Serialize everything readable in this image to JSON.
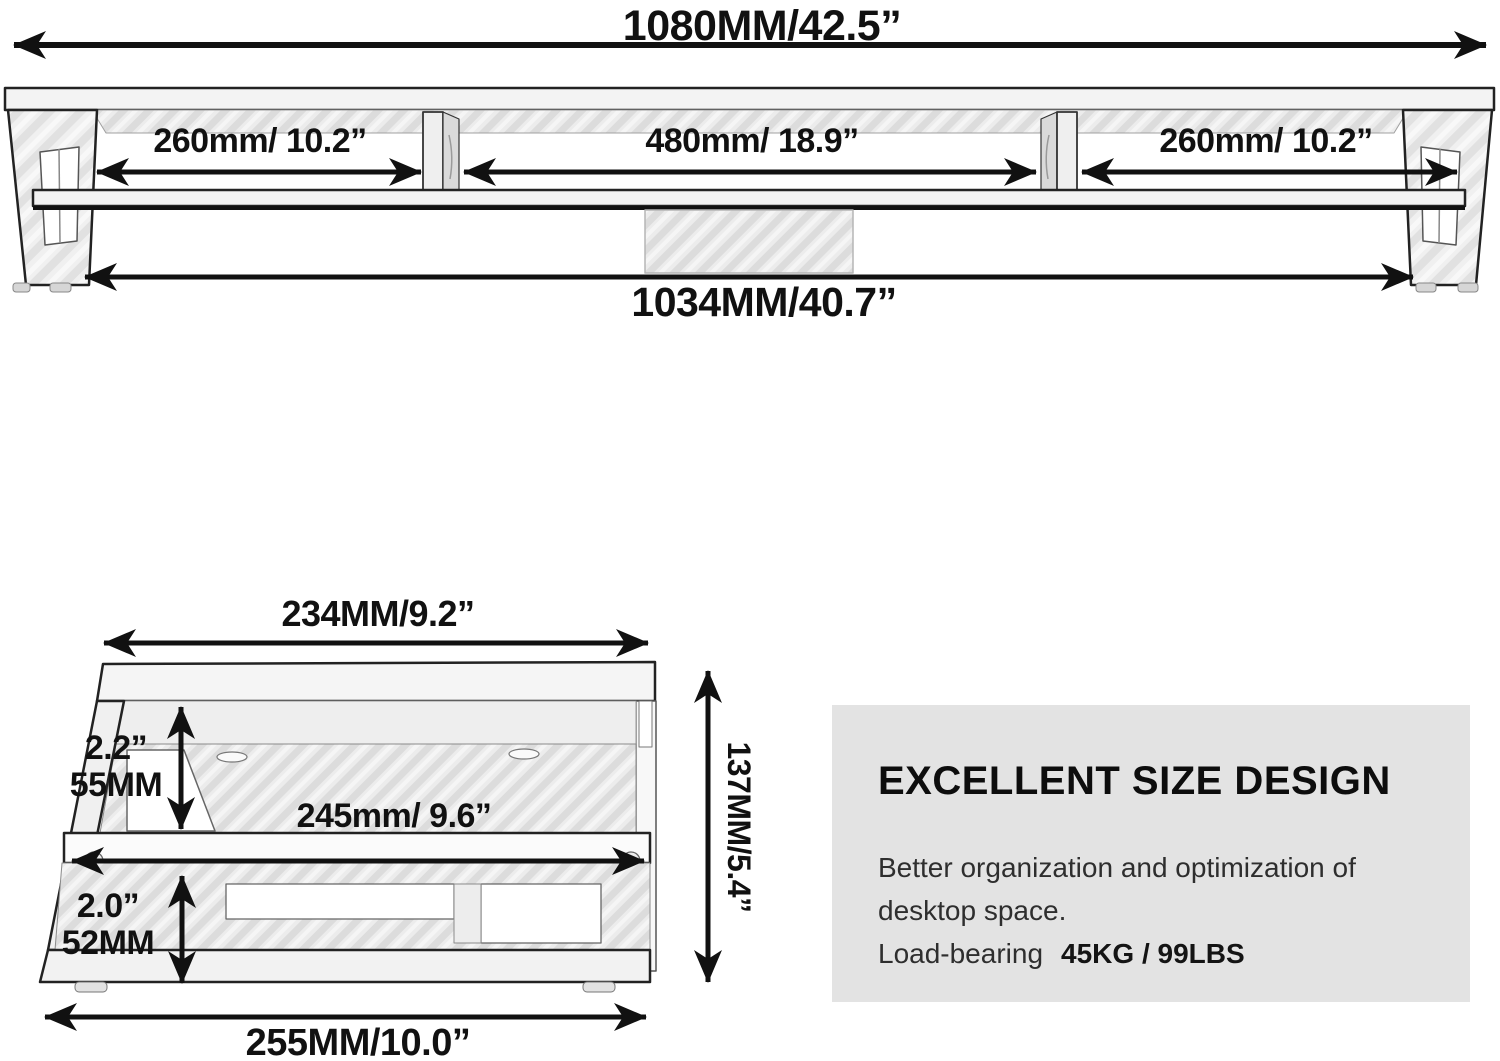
{
  "colors": {
    "line_art": "#111111",
    "drawing_fill_light": "#f2f2f2",
    "hatch_gray": "#dcdcdc",
    "info_box_background": "#e3e3e3"
  },
  "front_view": {
    "overall_width": "1080MM/42.5”",
    "sections": [
      {
        "label": "260mm/ 10.2”"
      },
      {
        "label": "480mm/ 18.9”"
      },
      {
        "label": "260mm/ 10.2”"
      }
    ],
    "inner_width": "1034MM/40.7”"
  },
  "side_view": {
    "top_width": "234MM/9.2”",
    "upper_gap_inches": "2.2”",
    "upper_gap_mm": "55MM",
    "shelf_width": "245mm/ 9.6”",
    "lower_gap_inches": "2.0”",
    "lower_gap_mm": "52MM",
    "base_width": "255MM/10.0”",
    "overall_height": "137MM/5.4”"
  },
  "info_box": {
    "heading": "EXCELLENT SIZE DESIGN",
    "line1": "Better organization and optimization of",
    "line2": "desktop space.",
    "load_label": "Load-bearing",
    "load_value": "45KG / 99LBS"
  }
}
